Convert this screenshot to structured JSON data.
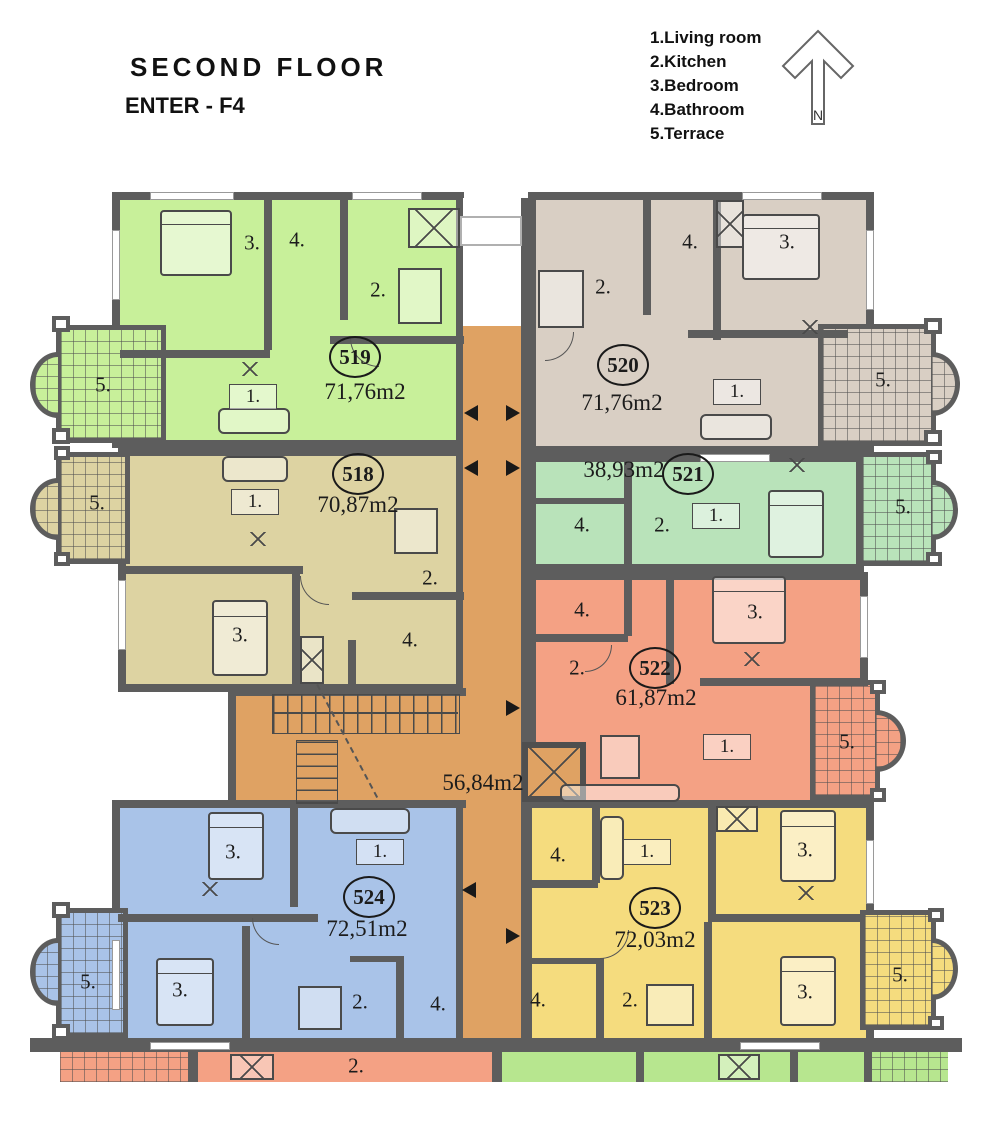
{
  "header": {
    "floor_title": "SECOND FLOOR",
    "enter_label": "ENTER - F4"
  },
  "legend": {
    "items": [
      "1.Living room",
      "2.Kitchen",
      "3.Bedroom",
      "4.Bathroom",
      "5.Terrace"
    ],
    "north_label": "N"
  },
  "corridor": {
    "area_label": "56,84m2"
  },
  "apartments": {
    "a519": {
      "number": "519",
      "area": "71,76m2",
      "rooms": {
        "bedroom": "3.",
        "bathroom": "4.",
        "kitchen": "2.",
        "living": "1.",
        "terrace": "5."
      }
    },
    "a520": {
      "number": "520",
      "area": "71,76m2",
      "rooms": {
        "kitchen": "2.",
        "bathroom": "4.",
        "bedroom": "3.",
        "living": "1.",
        "terrace": "5."
      }
    },
    "a518": {
      "number": "518",
      "area": "70,87m2",
      "rooms": {
        "living": "1.",
        "kitchen": "2.",
        "bedroom": "3.",
        "bathroom": "4.",
        "terrace": "5."
      }
    },
    "a521": {
      "number": "521",
      "area": "38,93m2",
      "rooms": {
        "bathroom": "4.",
        "kitchen": "2.",
        "living": "1.",
        "terrace": "5."
      }
    },
    "a522": {
      "number": "522",
      "area": "61,87m2",
      "rooms": {
        "bathroom": "4.",
        "bedroom": "3.",
        "kitchen": "2.",
        "living": "1.",
        "terrace": "5."
      }
    },
    "a524": {
      "number": "524",
      "area": "72,51m2",
      "rooms": {
        "bedroom1": "3.",
        "living": "1.",
        "bedroom2": "3.",
        "kitchen": "2.",
        "bathroom": "4.",
        "terrace": "5."
      }
    },
    "a523": {
      "number": "523",
      "area": "72,03m2",
      "rooms": {
        "bathroom1": "4.",
        "living": "1.",
        "bedroom1": "3.",
        "kitchen": "2.",
        "bedroom2": "3.",
        "bathroom2": "4.",
        "terrace": "5."
      }
    }
  },
  "lower_floor": {
    "kitchen_label": "2."
  },
  "colors": {
    "wall": "#5d5d5d",
    "corridor": "#dfa263",
    "a519": "#c8f09a",
    "a520": "#d9cfc4",
    "a518": "#ddd3a2",
    "a521": "#b9e3ba",
    "a522": "#f4a184",
    "a524": "#a9c3e8",
    "a523": "#f5dc7e",
    "lower_green": "#b7e68f"
  }
}
